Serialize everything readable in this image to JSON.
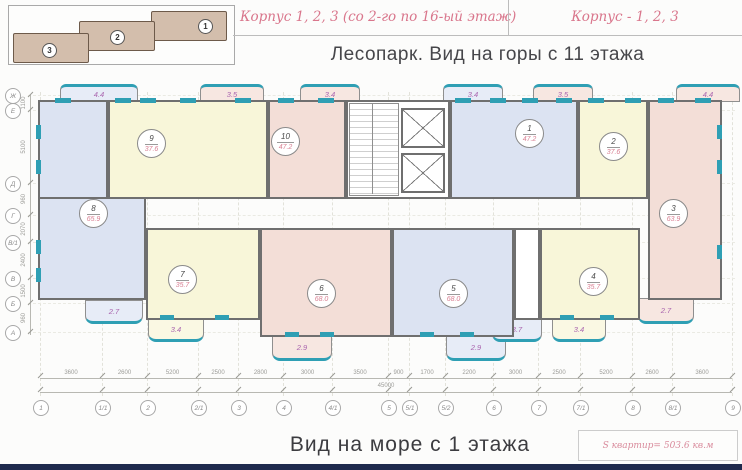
{
  "header": {
    "korpus_left": "Корпус 1, 2, 3 (со 2-го по 16-ый этаж)",
    "korpus_right": "Корпус  - 1, 2, 3",
    "subtitle": "Лесопарк. Вид на горы с 11 этажа"
  },
  "key_plan": {
    "blocks": [
      "1",
      "2",
      "3"
    ]
  },
  "plan": {
    "apartments": [
      {
        "number": "8",
        "area": "65.9"
      },
      {
        "number": "9",
        "area": "37.6"
      },
      {
        "number": "10",
        "area": "47.2"
      },
      {
        "number": "1",
        "area": "47.2"
      },
      {
        "number": "2",
        "area": "37.6"
      },
      {
        "number": "3",
        "area": "63.9"
      },
      {
        "number": "7",
        "area": "35.7"
      },
      {
        "number": "6",
        "area": "68.0"
      },
      {
        "number": "5",
        "area": "68.0"
      },
      {
        "number": "4",
        "area": "35.7"
      }
    ],
    "balconies": [
      "4.4",
      "3.5",
      "3.4",
      "3.4",
      "3.5",
      "4.4",
      "2.7",
      "3.4",
      "2.9",
      "2.9",
      "3.7",
      "3.4",
      "2.7"
    ],
    "axis_bottom": [
      "1",
      "1/1",
      "2",
      "2/1",
      "3",
      "4",
      "4/1",
      "5",
      "5/1",
      "5/2",
      "6",
      "7",
      "7/1",
      "8",
      "8/1",
      "9"
    ],
    "axis_left": [
      "Ж",
      "Е",
      "Д",
      "Г",
      "В/1",
      "В",
      "Б",
      "А"
    ],
    "dims_bottom": [
      "3600",
      "2600",
      "5200",
      "2500",
      "2800",
      "3000",
      "3500",
      "900",
      "1700",
      "2200",
      "3000",
      "2500",
      "5200",
      "2600",
      "3600"
    ],
    "dims_left": [
      "1100",
      "5100",
      "960",
      "2070",
      "2400",
      "1500",
      "960"
    ],
    "dims_total": "45000"
  },
  "footer": {
    "title": "Вид на море с 1 этажа",
    "total_area": "S квартир= 503.6 кв.м"
  },
  "colors": {
    "accent_pink": "#d9768c",
    "room_blue": "#dce3f2",
    "room_yellow": "#f8f6d9",
    "room_pink": "#f3ded7",
    "window_teal": "#2f9fb4",
    "balcony_label": "#a964ae",
    "footer_strip": "#1f2a4d"
  }
}
